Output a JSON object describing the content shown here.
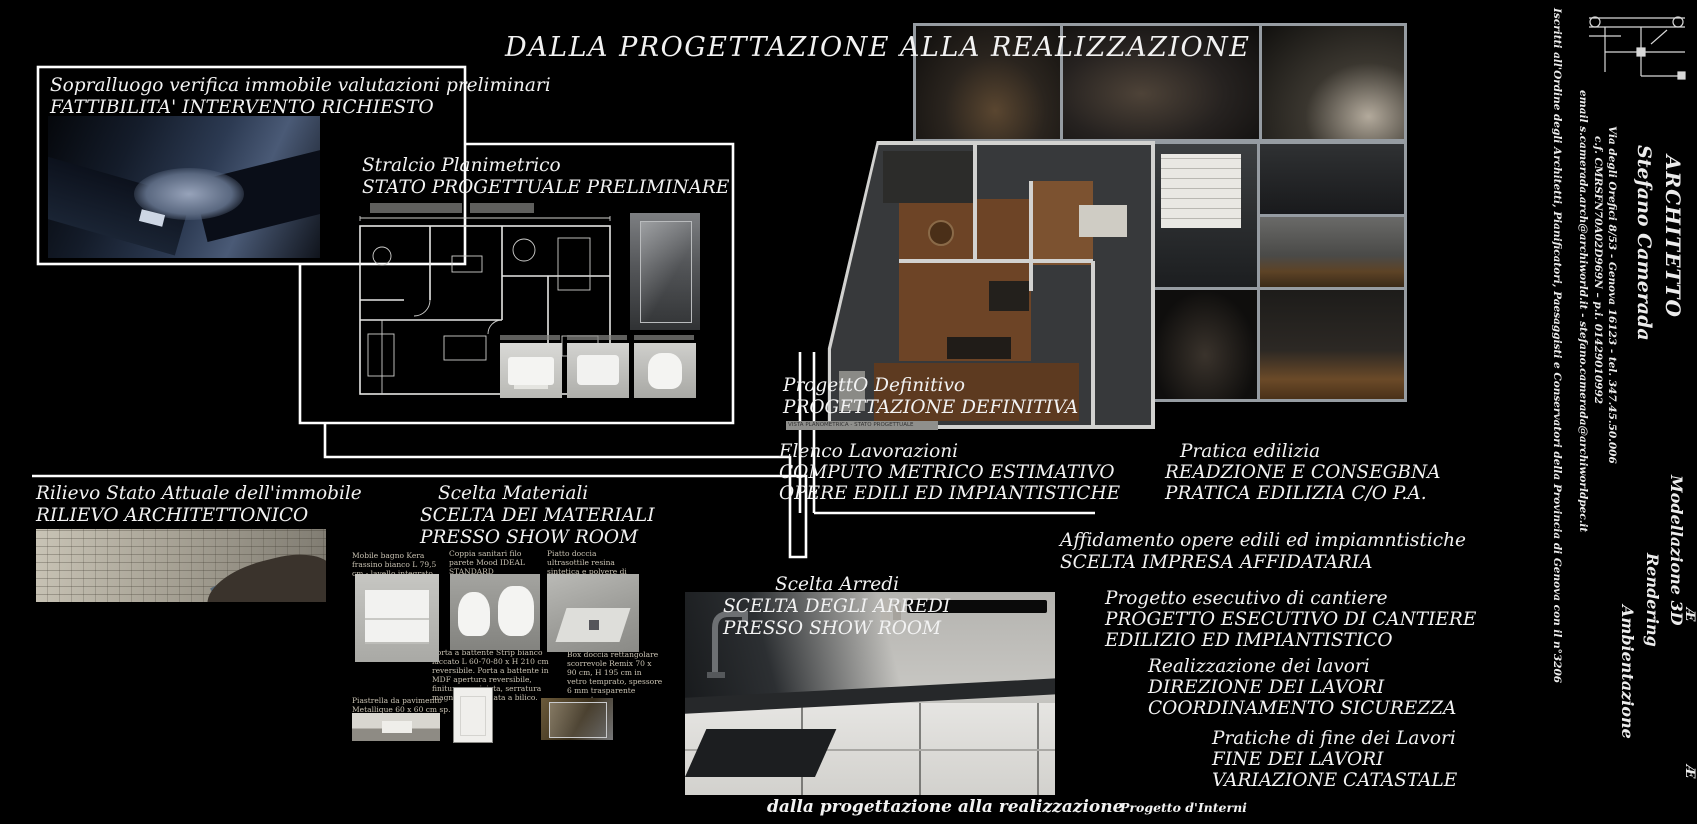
{
  "title": "DALLA PROGETTAZIONE ALLA REALIZZAZIONE",
  "steps": {
    "sopralluogo": {
      "title": "Sopralluogo verifica immobile valutazioni preliminari",
      "subtitle": "FATTIBILITA' INTERVENTO RICHIESTO"
    },
    "stralcio": {
      "title": "Stralcio Planimetrico",
      "subtitle": "STATO PROGETTUALE PRELIMINARE"
    },
    "progetto_definitivo": {
      "title": "ProgettO Definitivo",
      "subtitle": "PROGETTAZIONE DEFINITIVA",
      "caption": "VISTA PLANOMETRICA - STATO PROGETTUALE"
    },
    "elenco_lavorazioni": {
      "title": "Elenco Lavorazioni",
      "line2": "COMPUTO METRICO ESTIMATIVO",
      "line3": "OPERE EDILI ED IMPIANTISTICHE"
    },
    "pratica_edilizia": {
      "title": "Pratica edilizia",
      "line2": "READZIONE E CONSEGBNA",
      "line3": "PRATICA EDILIZIA C/O P.A."
    },
    "rilievo": {
      "title": "Rilievo Stato Attuale dell'immobile",
      "subtitle": "RILIEVO ARCHITETTONICO"
    },
    "scelta_materiali": {
      "title": "Scelta Materiali",
      "line2": "SCELTA DEI MATERIALI",
      "line3": "PRESSO SHOW ROOM"
    },
    "scelta_arredi": {
      "title": "Scelta Arredi",
      "line2": "SCELTA DEGLI ARREDI",
      "line3": "PRESSO SHOW ROOM"
    },
    "affidamento": {
      "title": "Affidamento opere edili ed impiamntistiche",
      "line2": "SCELTA IMPRESA AFFIDATARIA"
    },
    "esecutivo": {
      "title": "Progetto esecutivo di cantiere",
      "line2": "PROGETTO ESECUTIVO DI CANTIERE",
      "line3": "EDILIZIO ED IMPIANTISTICO"
    },
    "realizzazione": {
      "title": "Realizzazione dei lavori",
      "line2": "DIREZIONE DEI LAVORI",
      "line3": "COORDINAMENTO SICUREZZA"
    },
    "fine_lavori": {
      "title": "Pratiche di fine dei Lavori",
      "line2": "FINE DEI LAVORI",
      "line3": "VARIAZIONE CATASTALE"
    }
  },
  "products": [
    {
      "caption": "Mobile bagno Kera frassino bianco L 79,5 cm - lavello integrato"
    },
    {
      "caption": "Coppia sanitari filo parete Mood IDEAL STANDARD"
    },
    {
      "caption": "Piatto doccia ultrasottile resina sintetica e polvere di marmo Remix 70 x 90 cm bianco"
    },
    {
      "caption": "Porta a battente Strip bianco laccato L 60-70-80 x H 210 cm reversibile. Porta a battente in MDF apertura reversibile, finitura verniciata, serratura magnetica cromata a bilico."
    },
    {
      "caption": "Box doccia rettangolare scorrevole Remix 70 x 90 cm, H 195 cm in vetro temprato, spessore 6 mm trasparente cromato"
    },
    {
      "caption": "Piastrella da pavimento Metallique 60 x 60 cm sp. 10 mm PEI 4/5"
    }
  ],
  "footer": {
    "left": "dalla progettazione alla realizzazione",
    "right": "Progetto d'Interni"
  },
  "sidebar": {
    "profession": "ARCHITETTO",
    "name": "Stefano Camerada",
    "address": "Via degli Orefici 8/53  - Genova 16123 - tel. 347.45.50.006",
    "fiscal": "c.f. CMRSFN70A02D969N – p.i. 01429010992",
    "email": "email s.camerada.arch@archiworld.it - stefano.camerada@archiworldpec.it",
    "order": "Iscritti all'Ordine degli Architetti, Pianificatori, Paesaggisti e Conservatori della Provincia di Genova con il n°3206",
    "services": [
      "Modellazione 3D",
      "Rendering",
      "Ambientazione"
    ]
  },
  "edge_glyphs": [
    "Æ",
    "Æ"
  ],
  "colors": {
    "background": "#000000",
    "text": "#f2f2f2",
    "connector": "#ffffff",
    "collage_mat": "#969ca2"
  }
}
